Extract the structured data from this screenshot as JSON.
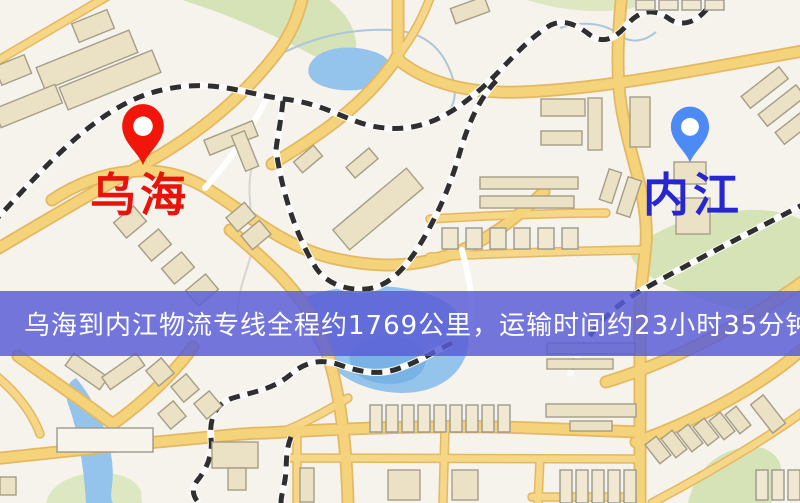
{
  "banner": {
    "text": "乌海到内江物流专线全程约1769公里，运输时间约23小时35分钟.",
    "origin": "乌海",
    "destination": "内江",
    "distance_text": "约1769公里",
    "duration_text": "约23小时35分钟",
    "background_color": "#595dd7",
    "text_color": "#ffffff"
  },
  "markers": {
    "origin": {
      "name": "乌海",
      "pin_color": "#f1150a",
      "label_color": "#e8130a"
    },
    "destination": {
      "name": "内江",
      "pin_color": "#4c8bf5",
      "label_color": "#2727d2"
    }
  },
  "map_palette": {
    "background": "#f6f2ec",
    "road_fill": "#f5d37a",
    "road_casing": "#e4b863",
    "building_fill": "#ebe2c6",
    "building_stroke": "#a59d86",
    "park": "#d5e3b6",
    "water": "#94c3ec",
    "railway_dash": "#2f2f2f",
    "railway_base": "#fbfbfb"
  }
}
